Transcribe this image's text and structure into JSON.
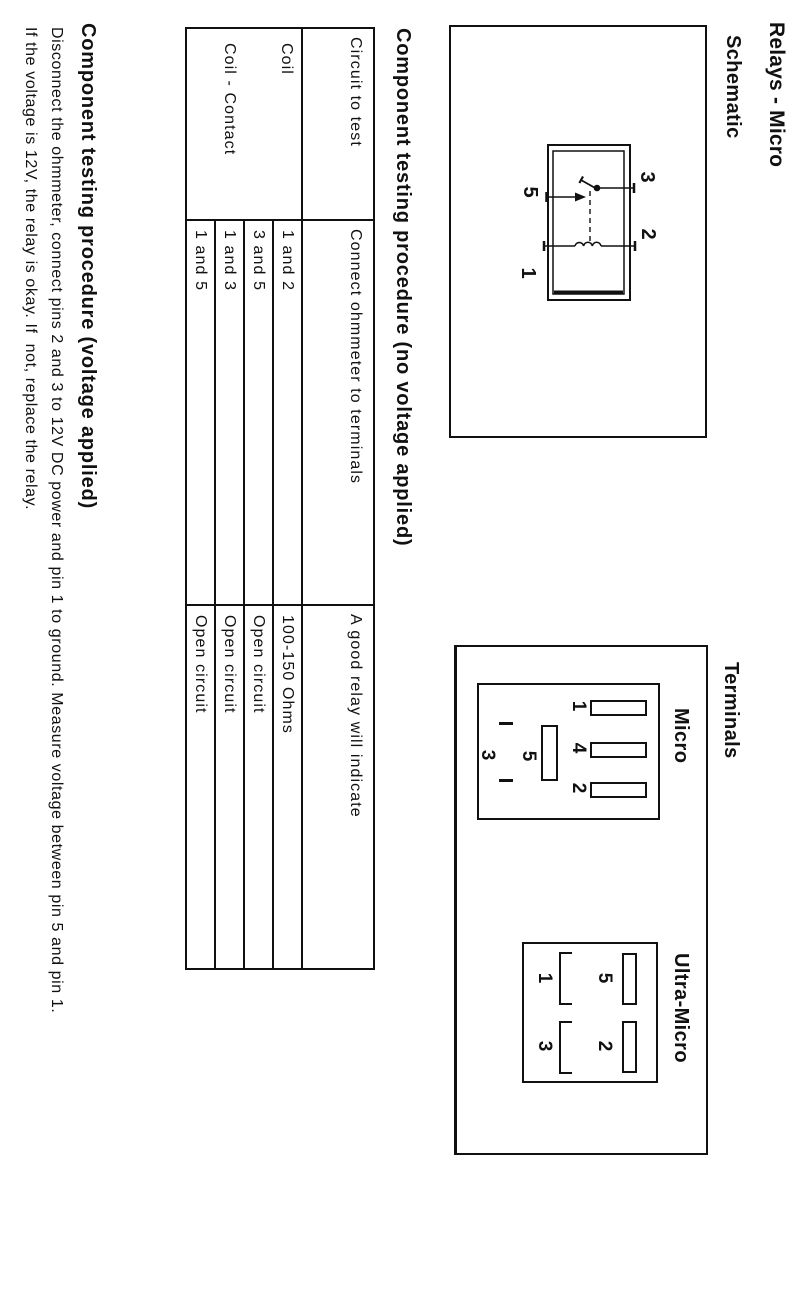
{
  "page": {
    "title": "Relays - Micro",
    "headings": {
      "schematic": "Schematic",
      "terminals": "Terminals",
      "procedure_no_voltage": "Component testing procedure (no voltage applied)",
      "procedure_voltage": "Component testing procedure (voltage applied)"
    },
    "paragraph": {
      "line1": "Disconnect the ohmmeter, connect pins 2 and 3 to 12V DC power and pin 1 to ground. Measure voltage between pin 5 and pin 1.",
      "line2": "If the voltage is 12V, the relay is okay. If  not, replace the relay."
    },
    "colors": {
      "ink": "#111111",
      "paper": "#ffffff"
    }
  },
  "schematic": {
    "pin_labels": {
      "three": "3",
      "two": "2",
      "five": "5",
      "one": "1"
    }
  },
  "terminals": {
    "micro": {
      "label": "Micro",
      "blades": [
        "1",
        "4",
        "2"
      ],
      "slot": "5",
      "pin3": "3"
    },
    "ultra_micro": {
      "label": "Ultra-Micro",
      "slots": [
        "5",
        "2"
      ],
      "brackets": [
        "1",
        "3"
      ]
    }
  },
  "table": {
    "headers": [
      "Circuit to test",
      "Connect ohmmeter to terminals",
      "A good relay will indicate"
    ],
    "groups": [
      "Coil",
      "Coil - Contact"
    ],
    "rows": [
      {
        "terminals": "1 and 2",
        "indication": "100-150 Ohms"
      },
      {
        "terminals": "3 and 5",
        "indication": "Open circuit"
      },
      {
        "terminals": "1 and 3",
        "indication": "Open circuit"
      },
      {
        "terminals": "1 and 5",
        "indication": "Open circuit"
      }
    ]
  }
}
